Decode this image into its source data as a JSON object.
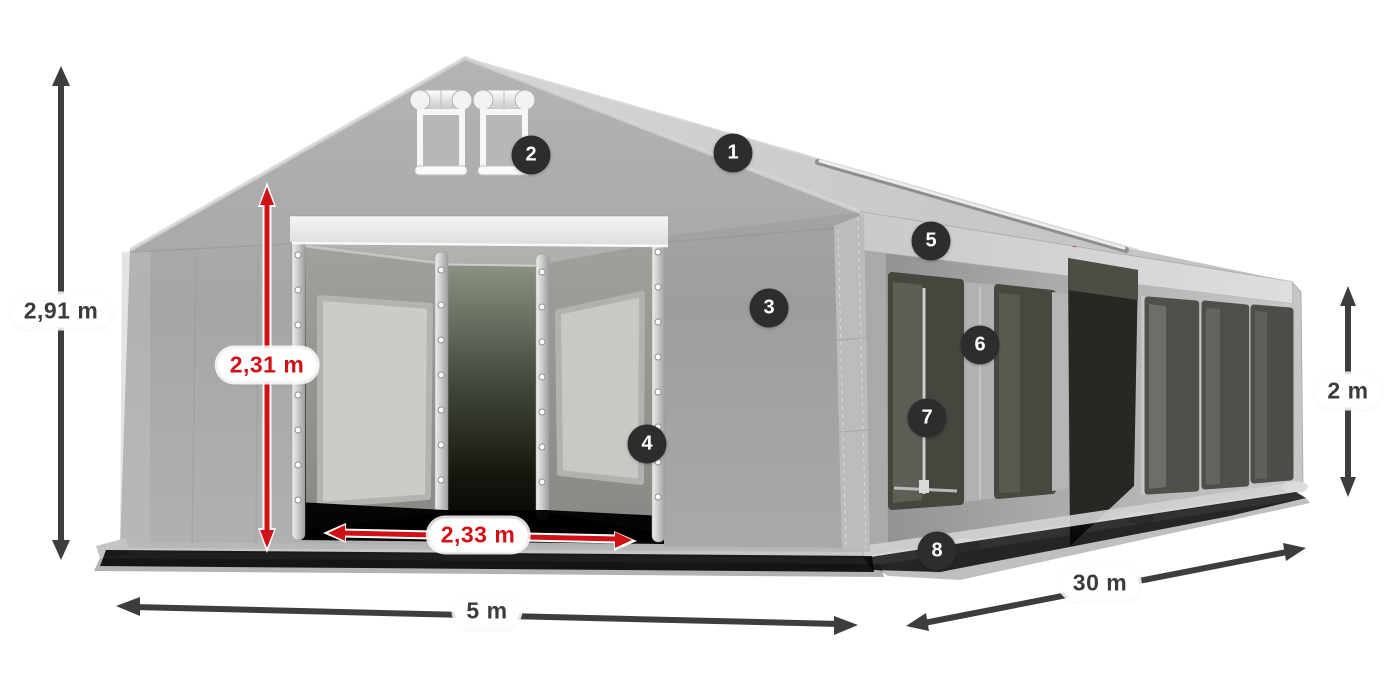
{
  "diagram": {
    "dimensions": {
      "total_height": "2,91 m",
      "door_height": "2,31 m",
      "door_width": "2,33 m",
      "tent_width": "5 m",
      "tent_length": "30 m",
      "side_height": "2 m"
    },
    "callouts": [
      "1",
      "2",
      "3",
      "4",
      "5",
      "6",
      "7",
      "8"
    ],
    "colors": {
      "dimension_red": "#d21117",
      "dimension_dark": "#3d3d3d",
      "callout_badge": "#2d2d2d",
      "label_pill": "#ffffff",
      "tent_fabric": "#adadad",
      "window_mesh": "#46463f"
    }
  }
}
